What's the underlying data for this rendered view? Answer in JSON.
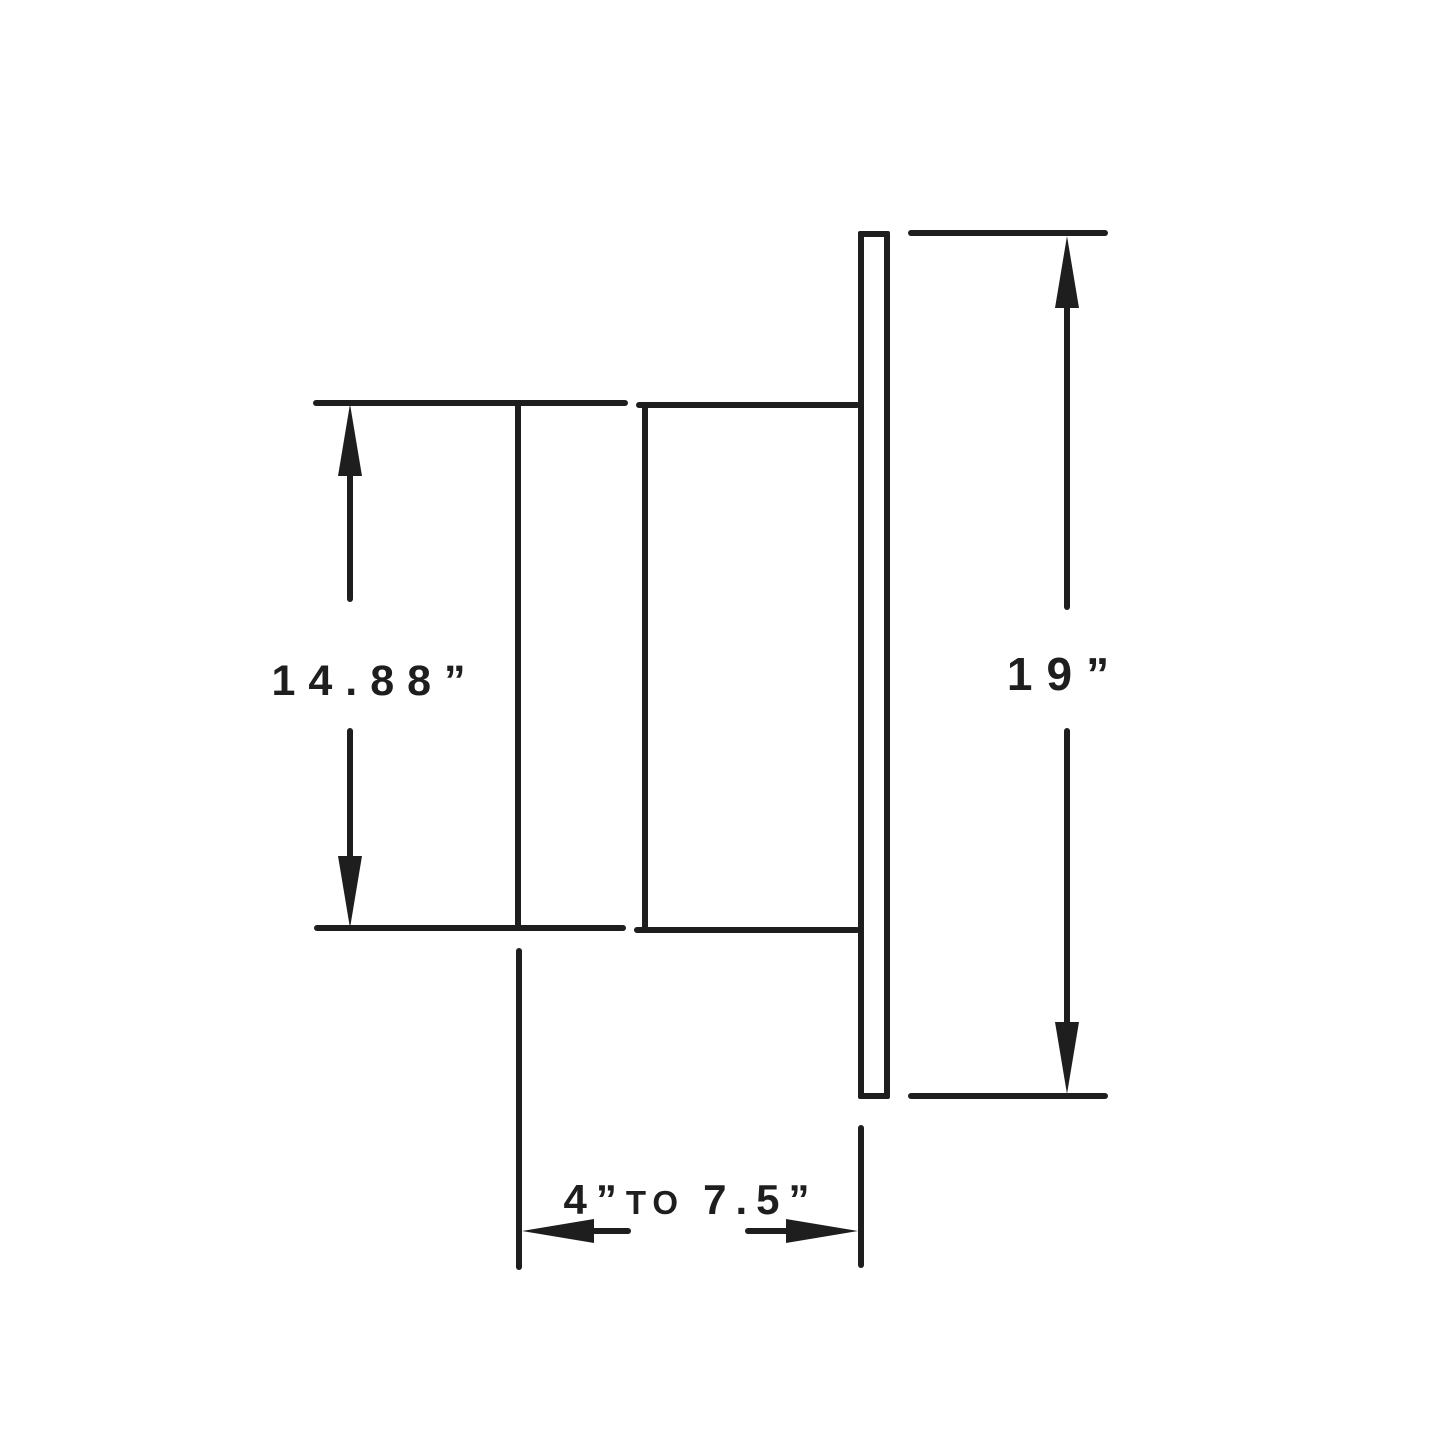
{
  "canvas": {
    "background": "#ffffff",
    "ink": "#1e1e1e"
  },
  "diagram": {
    "type": "technical-dimension-drawing",
    "view": "side-profile of recessed fixture with mounting flange",
    "dimensions": {
      "body_height": {
        "label": "14.88”",
        "inches": 14.88
      },
      "flange_height": {
        "label": "19”",
        "inches": 19
      },
      "mounting_depth": {
        "min_label": "4”",
        "connector": "TO",
        "max_label": "7.5”",
        "full_label": "4”TO 7.5”",
        "min_inches": 4,
        "max_inches": 7.5
      }
    }
  }
}
